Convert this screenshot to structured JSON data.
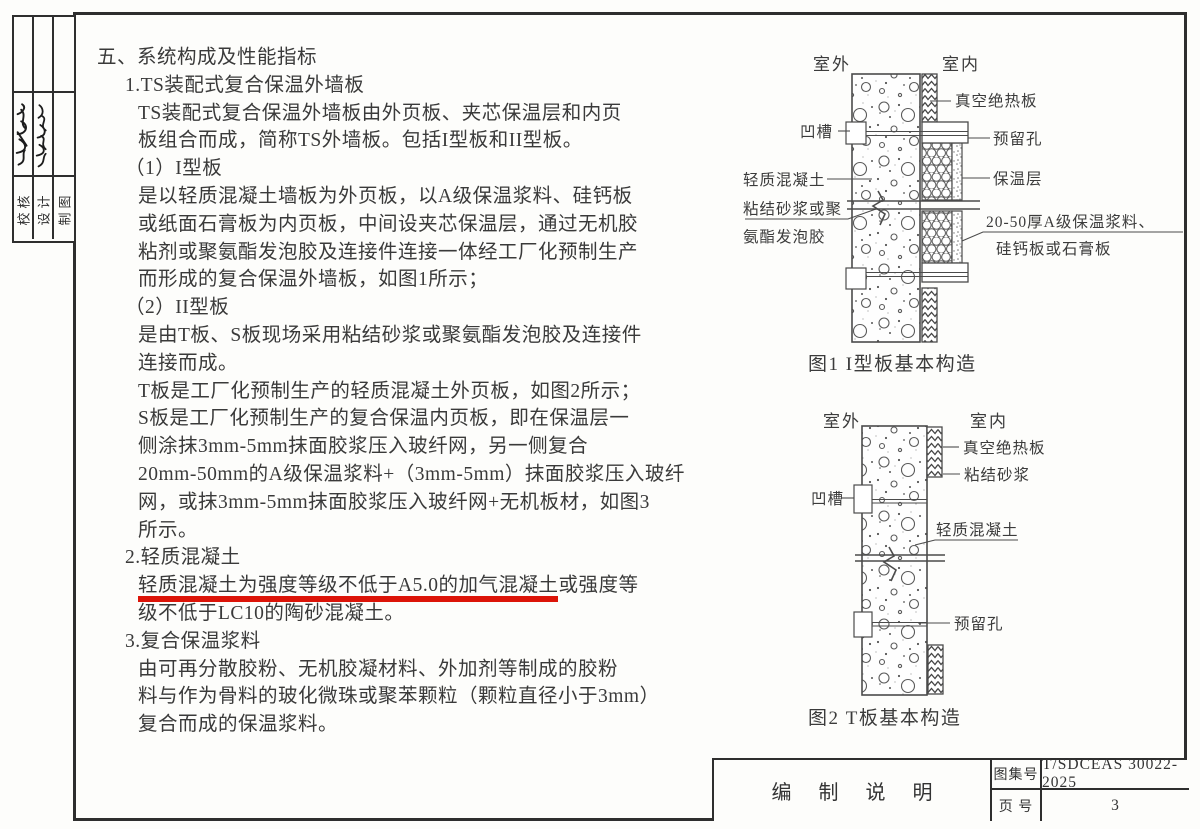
{
  "side": {
    "labels": [
      "校核",
      "设计",
      "制图"
    ]
  },
  "content": {
    "lines": [
      {
        "indent": 0,
        "segments": [
          {
            "text": "五、系统构成及性能指标"
          }
        ]
      },
      {
        "indent": 1,
        "segments": [
          {
            "text": "1.TS装配式复合保温外墙板"
          }
        ]
      },
      {
        "indent": 2,
        "segments": [
          {
            "text": "TS装配式复合保温外墙板由外页板、夹芯保温层和内页"
          }
        ]
      },
      {
        "indent": 2,
        "segments": [
          {
            "text": "板组合而成，简称TS外墙板。包括I型板和II型板。"
          }
        ]
      },
      {
        "indent": 1,
        "segments": [
          {
            "text": "（1）I型板"
          }
        ]
      },
      {
        "indent": 2,
        "segments": [
          {
            "text": "是以轻质混凝土墙板为外页板，以A级保温浆料、硅钙板"
          }
        ]
      },
      {
        "indent": 2,
        "segments": [
          {
            "text": "或纸面石膏板为内页板，中间设夹芯保温层，通过无机胶"
          }
        ]
      },
      {
        "indent": 2,
        "segments": [
          {
            "text": "粘剂或聚氨酯发泡胶及连接件连接一体经工厂化预制生产"
          }
        ]
      },
      {
        "indent": 2,
        "segments": [
          {
            "text": "而形成的复合保温外墙板，如图1所示；"
          }
        ]
      },
      {
        "indent": 1,
        "segments": [
          {
            "text": "（2）II型板"
          }
        ]
      },
      {
        "indent": 2,
        "segments": [
          {
            "text": "是由T板、S板现场采用粘结砂浆或聚氨酯发泡胶及连接件"
          }
        ]
      },
      {
        "indent": 2,
        "segments": [
          {
            "text": "连接而成。"
          }
        ]
      },
      {
        "indent": 2,
        "segments": [
          {
            "text": "T板是工厂化预制生产的轻质混凝土外页板，如图2所示；"
          }
        ]
      },
      {
        "indent": 2,
        "segments": [
          {
            "text": "S板是工厂化预制生产的复合保温内页板，即在保温层一"
          }
        ]
      },
      {
        "indent": 2,
        "segments": [
          {
            "text": "侧涂抹3mm-5mm抹面胶浆压入玻纤网，另一侧复合"
          }
        ]
      },
      {
        "indent": 2,
        "segments": [
          {
            "text": "20mm-50mm的A级保温浆料+（3mm-5mm）抹面胶浆压入玻纤"
          }
        ]
      },
      {
        "indent": 2,
        "segments": [
          {
            "text": "网，或抹3mm-5mm抹面胶浆压入玻纤网+无机板材，如图3"
          }
        ]
      },
      {
        "indent": 2,
        "segments": [
          {
            "text": "所示。"
          }
        ]
      },
      {
        "indent": 1,
        "segments": [
          {
            "text": "2.轻质混凝土"
          }
        ]
      },
      {
        "indent": 2,
        "segments": [
          {
            "text": "轻质混凝土为强度等级不低于A5.0的加气混凝土",
            "red_underline": true
          },
          {
            "text": "或强度等"
          }
        ]
      },
      {
        "indent": 2,
        "segments": [
          {
            "text": "级不低于LC10的陶砂混凝土。"
          }
        ]
      },
      {
        "indent": 1,
        "segments": [
          {
            "text": "3.复合保温浆料"
          }
        ]
      },
      {
        "indent": 2,
        "segments": [
          {
            "text": "由可再分散胶粉、无机胶凝材料、外加剂等制成的胶粉"
          }
        ]
      },
      {
        "indent": 2,
        "segments": [
          {
            "text": "料与作为骨料的玻化微珠或聚苯颗粒（颗粒直径小于3mm）"
          }
        ]
      },
      {
        "indent": 2,
        "segments": [
          {
            "text": "复合而成的保温浆料。"
          }
        ]
      }
    ]
  },
  "fig1": {
    "caption": "图1  I型板基本构造",
    "outdoor": "室外",
    "indoor": "室内",
    "labels": {
      "vacuum": "真空绝热板",
      "hole": "预留孔",
      "insulation": "保温层",
      "slurry_line1": "20-50厚A级保温浆料、",
      "slurry_line2": "硅钙板或石膏板",
      "groove": "凹槽",
      "lwc": "轻质混凝土",
      "mortar_line1": "粘结砂浆或聚",
      "mortar_line2": "氨酯发泡胶"
    }
  },
  "fig2": {
    "caption": "图2  T板基本构造",
    "outdoor": "室外",
    "indoor": "室内",
    "labels": {
      "vacuum": "真空绝热板",
      "mortar": "粘结砂浆",
      "groove": "凹槽",
      "lwc": "轻质混凝土",
      "hole": "预留孔"
    }
  },
  "title_block": {
    "doc_title": "编 制 说 明",
    "atlas_no_label": "图集号",
    "atlas_no": "T/SDCEAS 30022-2025",
    "page_no_label": "页 号",
    "page_no": "3"
  },
  "colors": {
    "highlight_red": "#dc1408",
    "ink": "#3a3a3a"
  }
}
